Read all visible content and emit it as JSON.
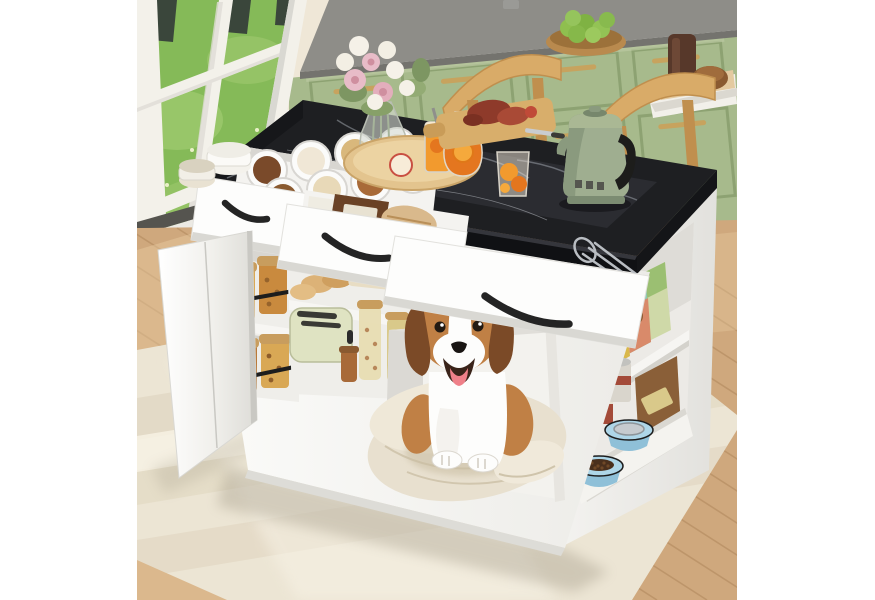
{
  "meta": {
    "type": "product-photo",
    "subject": "White kitchen island with black faux-marble top, open storage drawers, built-in dog house with a beagle on a cushion, and pet-food shelving, staged in a kitchen with sage-green cabinets and a garden window"
  },
  "palette": {
    "wall": "#f6f4ef",
    "wallWarm": "#ece3cf",
    "grass": "#85ba58",
    "grassLight": "#a8cf78",
    "trunk": "#3a463b",
    "windowFrame": "#f3f1ea",
    "frameShade": "#d9d8d2",
    "sillDark": "#55544f",
    "cabinetGreen": "#a7ba8c",
    "cabinetGreenDark": "#8da272",
    "cabinetGreenLight": "#bac9a1",
    "cabinetMint": "#cfe0bb",
    "brass": "#c7a35e",
    "counterGray": "#8e8d88",
    "counterGrayDark": "#74736e",
    "marble": "#1e1f22",
    "marbleSheen": "#32343a",
    "marbleVein": "#9aa0a8",
    "marbleSide": "#101114",
    "islandWhite": "#fafaf8",
    "islandShade": "#e6e5e1",
    "islandDark": "#cbcac6",
    "handleBlack": "#242424",
    "chairWood": "#d9ab68",
    "chairWoodDark": "#c08f4e",
    "kettleGreen": "#9fae90",
    "kettleGreenDark": "#77876c",
    "floorWood": "#cfa87d",
    "floorWoodDark": "#ad8459",
    "floorWoodLight": "#e8cda2",
    "rug": "#ece5d4",
    "rugDark": "#ddd2bb",
    "rugLight": "#f7f2e5",
    "cushion": "#e8e0cf",
    "cushionShadow": "#cfc4ab",
    "dogTan": "#c08045",
    "dogDark": "#7b4a27",
    "dogWhite": "#fdfdfc",
    "dogTongue": "#ef8089",
    "dogNose": "#191513",
    "bowlBlue": "#aed6e8",
    "kibbleBrown": "#4a2f1c",
    "waterGray": "#c6cbcf",
    "bagCream": "#e9ddc4",
    "bagYellow": "#d9b84a",
    "bagTeal": "#8fc9b2",
    "bagSalmon": "#d98a6a",
    "canRed": "#a34a38",
    "juiceOrange": "#f29a2e",
    "juiceDeep": "#e4761f",
    "boardWood": "#d8ae6b",
    "trayWood": "#e3c48e",
    "flowerPink": "#e8bcc8",
    "flowerWhite": "#f5f1e8",
    "leafGreen": "#7d9662",
    "jarNut": "#d9a855",
    "breadTan": "#dcb277",
    "roastRed": "#8e3a2a",
    "toasterCream": "#dfe3c2"
  },
  "scene": {
    "objects": [
      {
        "name": "garden-window",
        "label": "White-framed window with lawn and tree trunks outside"
      },
      {
        "name": "green-cabinets",
        "label": "Sage green kitchen cabinets with brass pulls"
      },
      {
        "name": "back-counter",
        "label": "Gray countertop with bowl of green fruit and serving boards"
      },
      {
        "name": "dining-chairs",
        "label": "Two light-wood chairs behind the island"
      },
      {
        "name": "kitchen-island",
        "label": "White kitchen island with black marble-look top"
      },
      {
        "name": "spice-drawer",
        "label": "Open drawer with round spice containers"
      },
      {
        "name": "baking-drawer",
        "label": "Open drawer with baking packages"
      },
      {
        "name": "cutlery-drawer",
        "label": "Open drawer with cutlery organizer"
      },
      {
        "name": "snack-cabinet",
        "label": "Open cabinet door revealing jars of snacks"
      },
      {
        "name": "pantry-shelf",
        "label": "Open shelf with toaster, bread and jars"
      },
      {
        "name": "dog-house",
        "label": "Built-in dog house with beagle on a cream cushion"
      },
      {
        "name": "pet-food-shelf",
        "label": "End shelves with dog food bags and cans"
      },
      {
        "name": "pet-bowl-tray",
        "label": "Pull-out tray with blue water and kibble bowls"
      },
      {
        "name": "retro-kettle",
        "label": "Sage green retro electric kettle"
      },
      {
        "name": "flower-vase",
        "label": "Glass vase with pink and white flowers"
      },
      {
        "name": "drink-tray",
        "label": "Round wood tray with orange drinks and cutting board"
      },
      {
        "name": "area-rug",
        "label": "Cream striped area rug over wood floor"
      }
    ]
  }
}
